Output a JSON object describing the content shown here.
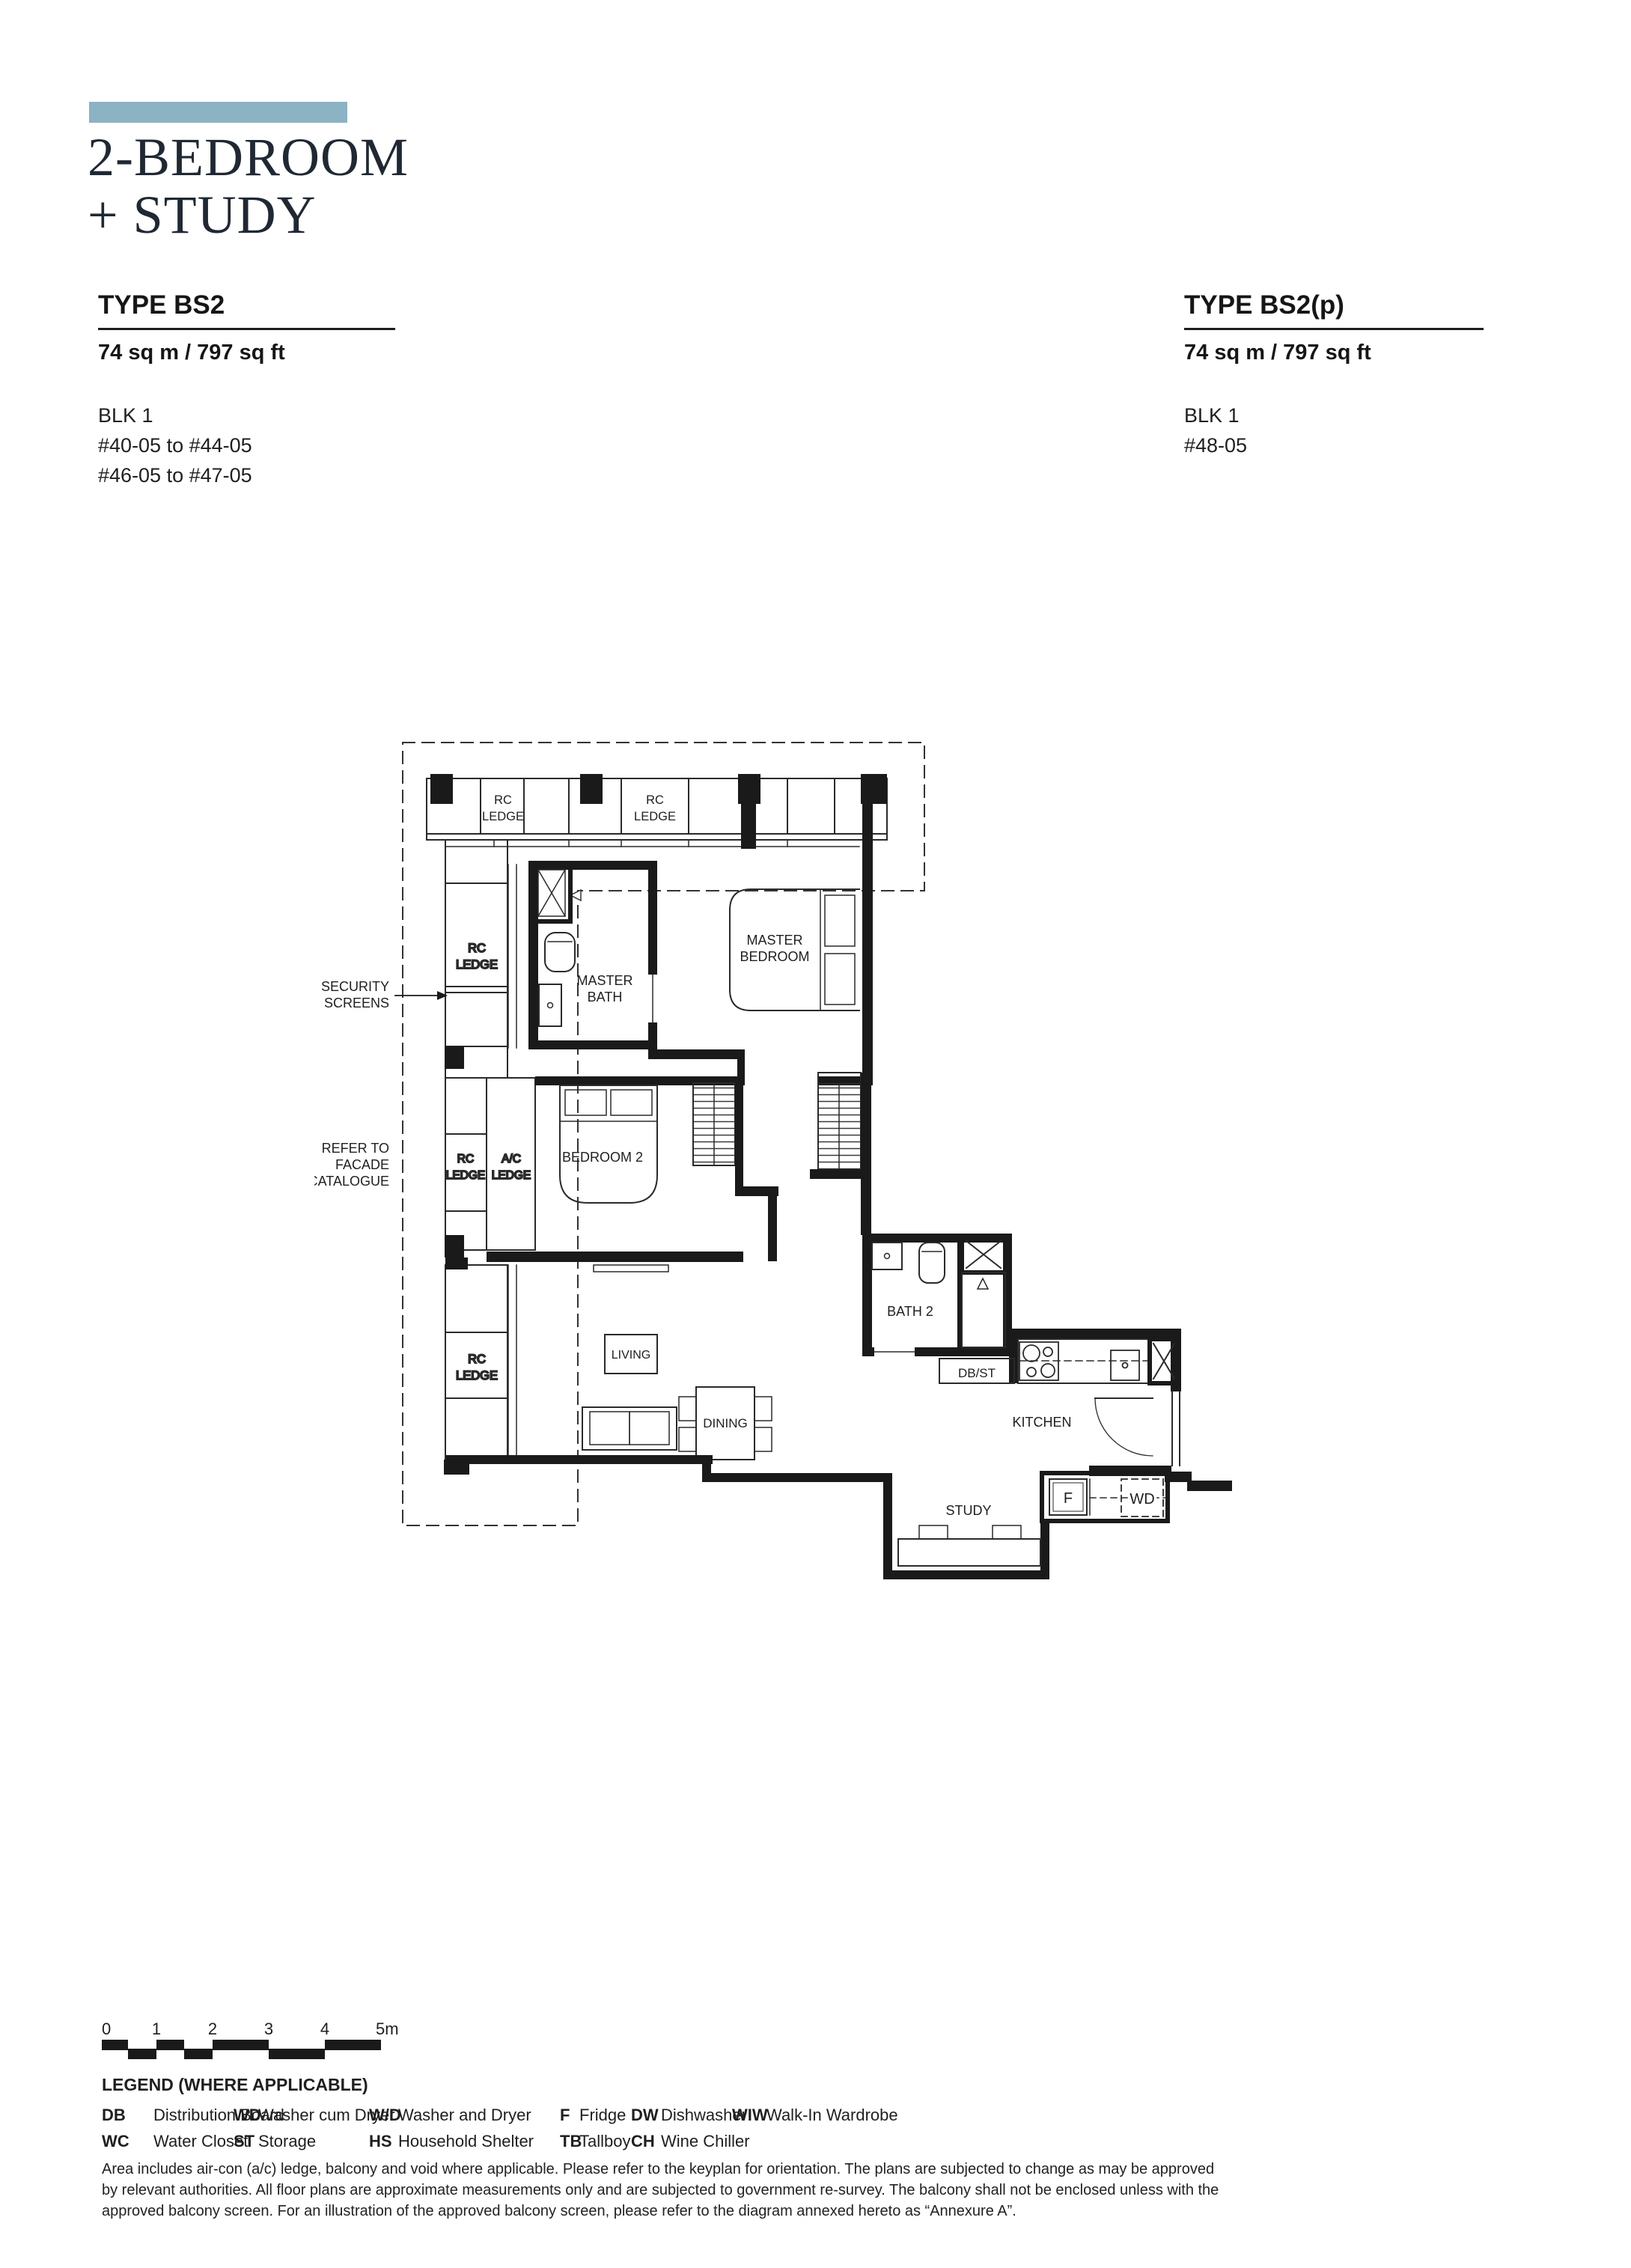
{
  "page": {
    "accent_color": "#8bb3c4"
  },
  "header": {
    "title_line1": "2-BEDROOM",
    "title_line2": "+ STUDY"
  },
  "specs": {
    "left": {
      "type": "TYPE BS2",
      "area": "74 sq m / 797 sq ft",
      "block": "BLK 1",
      "units": [
        "#40-05 to #44-05",
        "#46-05 to #47-05"
      ]
    },
    "right": {
      "type": "TYPE BS2(p)",
      "area": "74 sq m / 797 sq ft",
      "block": "BLK 1",
      "units": [
        "#48-05"
      ]
    }
  },
  "floorplan": {
    "labels": {
      "rc": "RC",
      "ledge": "LEDGE",
      "ac": "A/C",
      "master": "MASTER",
      "bedroom": "BEDROOM",
      "bath": "BATH",
      "bedroom2": "BEDROOM 2",
      "living": "LIVING",
      "dining": "DINING",
      "bath2": "BATH 2",
      "db_st": "DB/ST",
      "kitchen": "KITCHEN",
      "study": "STUDY",
      "fridge": "F",
      "washer_dryer": "WD"
    },
    "annotations": {
      "security_line1": "SECURITY",
      "security_line2": "SCREENS",
      "facade_line1": "REFER TO",
      "facade_line2": "FACADE",
      "facade_line3": "CATALOGUE"
    }
  },
  "scale_bar": {
    "ticks": [
      "0",
      "1",
      "2",
      "3",
      "4",
      "5m"
    ]
  },
  "legend": {
    "title": "LEGEND (WHERE APPLICABLE)",
    "items": [
      {
        "abbr": "DB",
        "desc": "Distribution Board"
      },
      {
        "abbr": "WC",
        "desc": "Water Closet"
      },
      {
        "abbr": "WD",
        "desc": "Washer cum Dryer"
      },
      {
        "abbr": "ST",
        "desc": "Storage"
      },
      {
        "abbr": "W/D",
        "desc": "Washer and Dryer"
      },
      {
        "abbr": "HS",
        "desc": "Household Shelter"
      },
      {
        "abbr": "F",
        "desc": "Fridge"
      },
      {
        "abbr": "TB",
        "desc": "Tallboy"
      },
      {
        "abbr": "DW",
        "desc": "Dishwasher"
      },
      {
        "abbr": "CH",
        "desc": "Wine Chiller"
      },
      {
        "abbr": "WIW",
        "desc": "Walk-In Wardrobe"
      }
    ]
  },
  "disclaimer": "Area includes air-con (a/c) ledge, balcony and void where applicable. Please refer to the keyplan for orientation. The plans are subjected to change as may be approved by relevant authorities. All floor plans are approximate measurements only and are subjected to government re-survey. The balcony shall not be enclosed unless with the approved balcony screen. For an illustration of the approved balcony screen, please refer to the diagram annexed hereto as “Annexure A”."
}
